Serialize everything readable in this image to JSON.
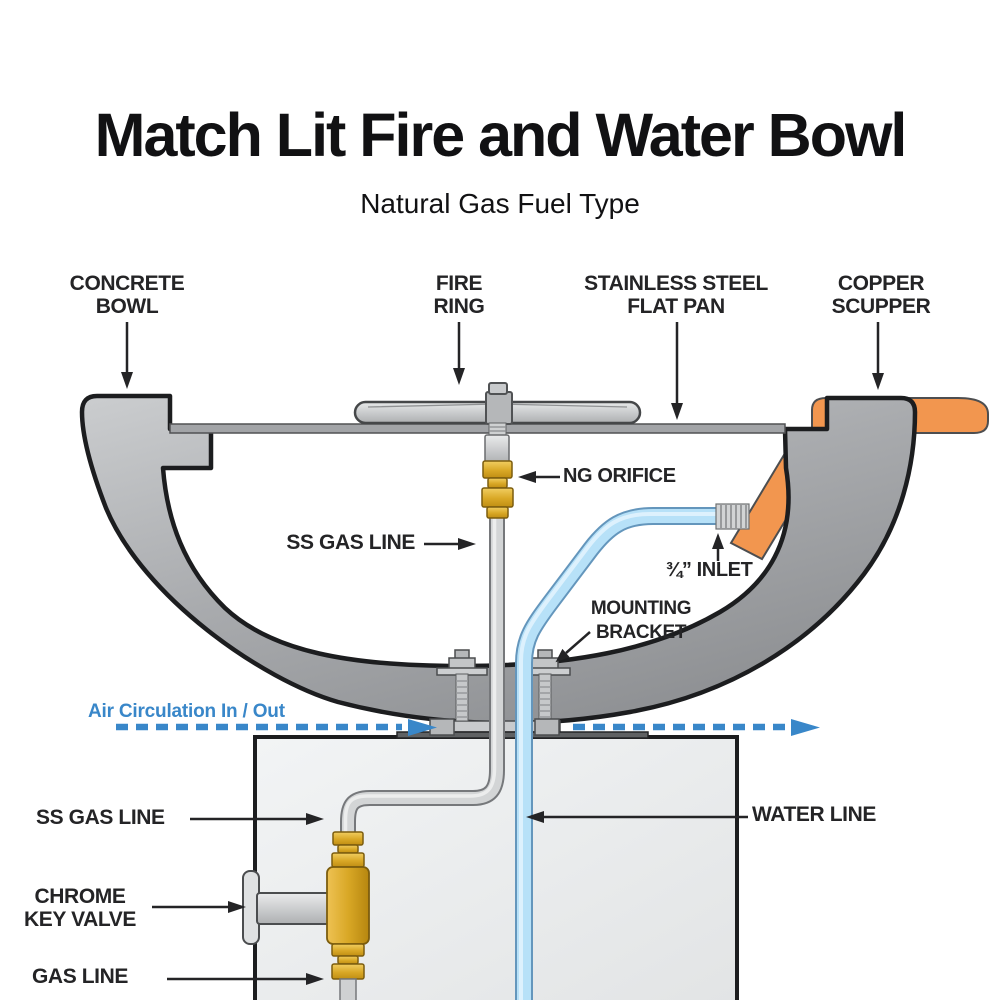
{
  "title": "Match Lit Fire and Water Bowl",
  "subtitle": "Natural Gas Fuel Type",
  "labels": {
    "concrete_bowl_1": "CONCRETE",
    "concrete_bowl_2": "BOWL",
    "fire_ring_1": "FIRE",
    "fire_ring_2": "RING",
    "flat_pan_1": "STAINLESS STEEL",
    "flat_pan_2": "FLAT PAN",
    "copper_scupper_1": "COPPER",
    "copper_scupper_2": "SCUPPER",
    "ng_orifice": "NG ORIFICE",
    "ss_gas_line_upper": "SS GAS LINE",
    "inlet": "¾” INLET",
    "mounting_bracket_1": "MOUNTING",
    "mounting_bracket_2": "BRACKET",
    "air_circulation": "Air Circulation In / Out",
    "ss_gas_line_lower": "SS GAS LINE",
    "water_line": "WATER LINE",
    "chrome_key_valve_1": "CHROME",
    "chrome_key_valve_2": "KEY VALVE",
    "gas_line": "GAS LINE"
  },
  "colors": {
    "label_text": "#242426",
    "air_circulation_blue": "#3987c9",
    "copper_orange": "#f2964f",
    "brass_gold": "#d9a826",
    "bowl_gray": "#aeb0b3",
    "water_blue": "#b7e1f8",
    "pipe_gray": "#d3d5d6",
    "pedestal_gray": "#eceeef",
    "outline_black": "#1c1d1f"
  }
}
